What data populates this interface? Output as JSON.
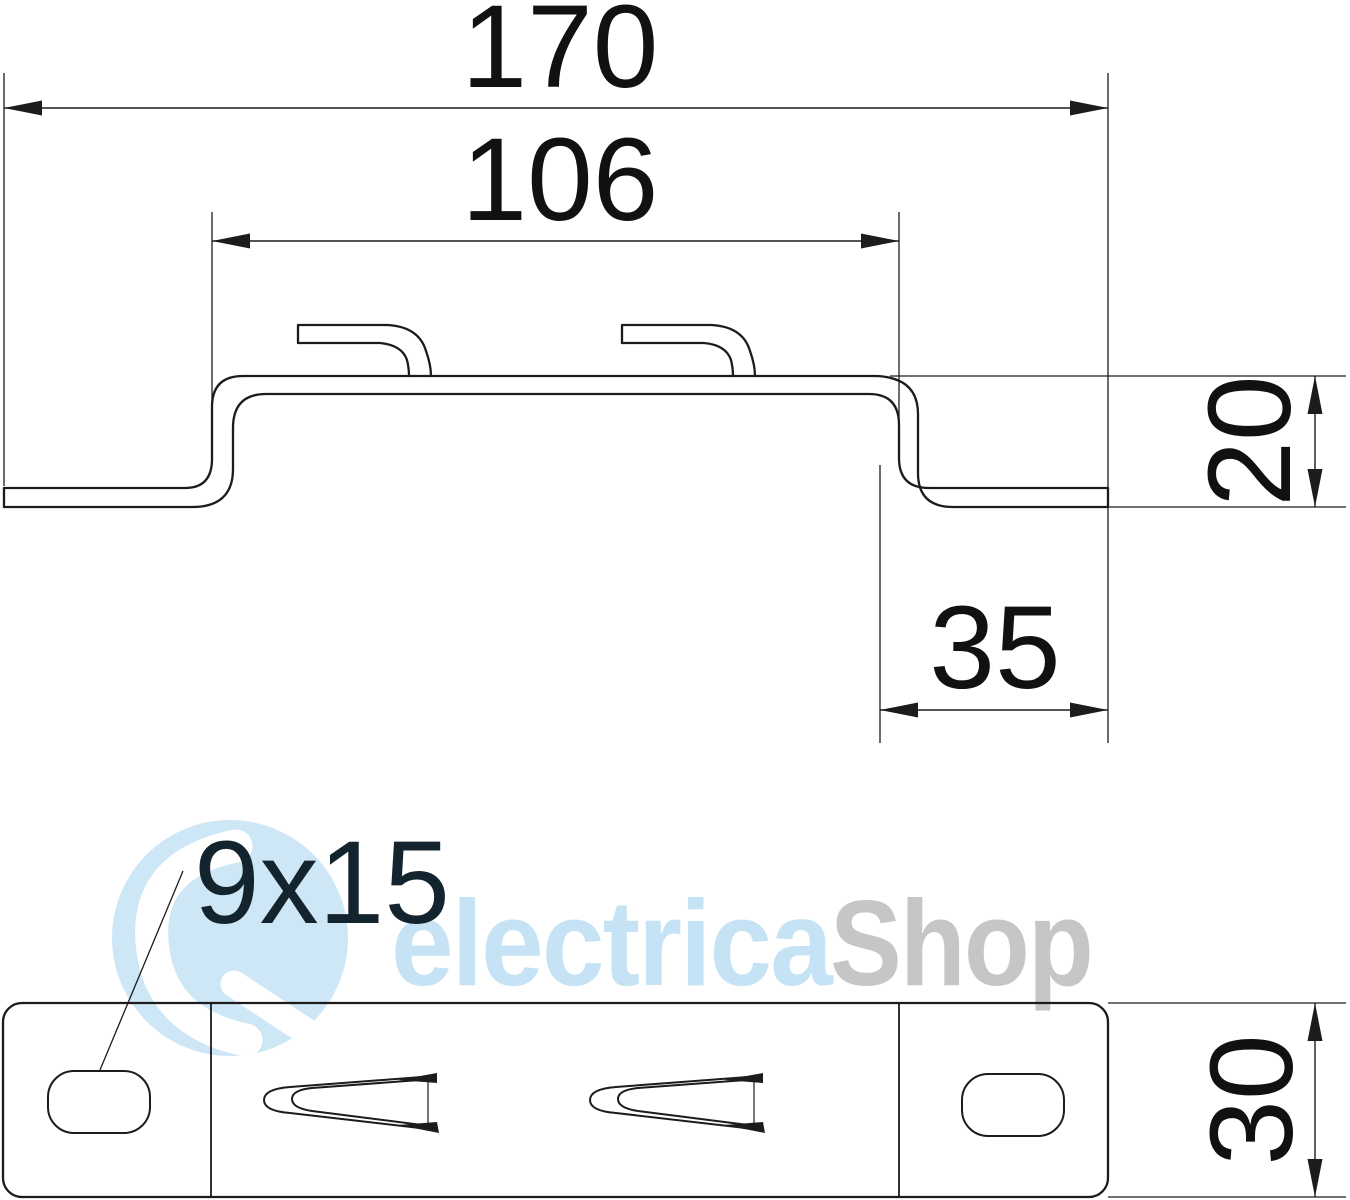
{
  "drawing": {
    "type": "technical-drawing",
    "dimensions": {
      "total_width": "170",
      "inner_width": "106",
      "profile_height": "20",
      "end_offset": "35",
      "slot_size": "9x15",
      "plate_depth": "30"
    },
    "watermark": {
      "brand_primary": "electrica",
      "brand_secondary": "Shop"
    },
    "colors": {
      "line": "#1c1c1c",
      "dimension_text": "#111111",
      "slot_label_text": "#14242e",
      "watermark_blue": "#c5e3f4",
      "watermark_gray": "#c6c6c8",
      "logo_blue": "#cde7f6"
    }
  }
}
